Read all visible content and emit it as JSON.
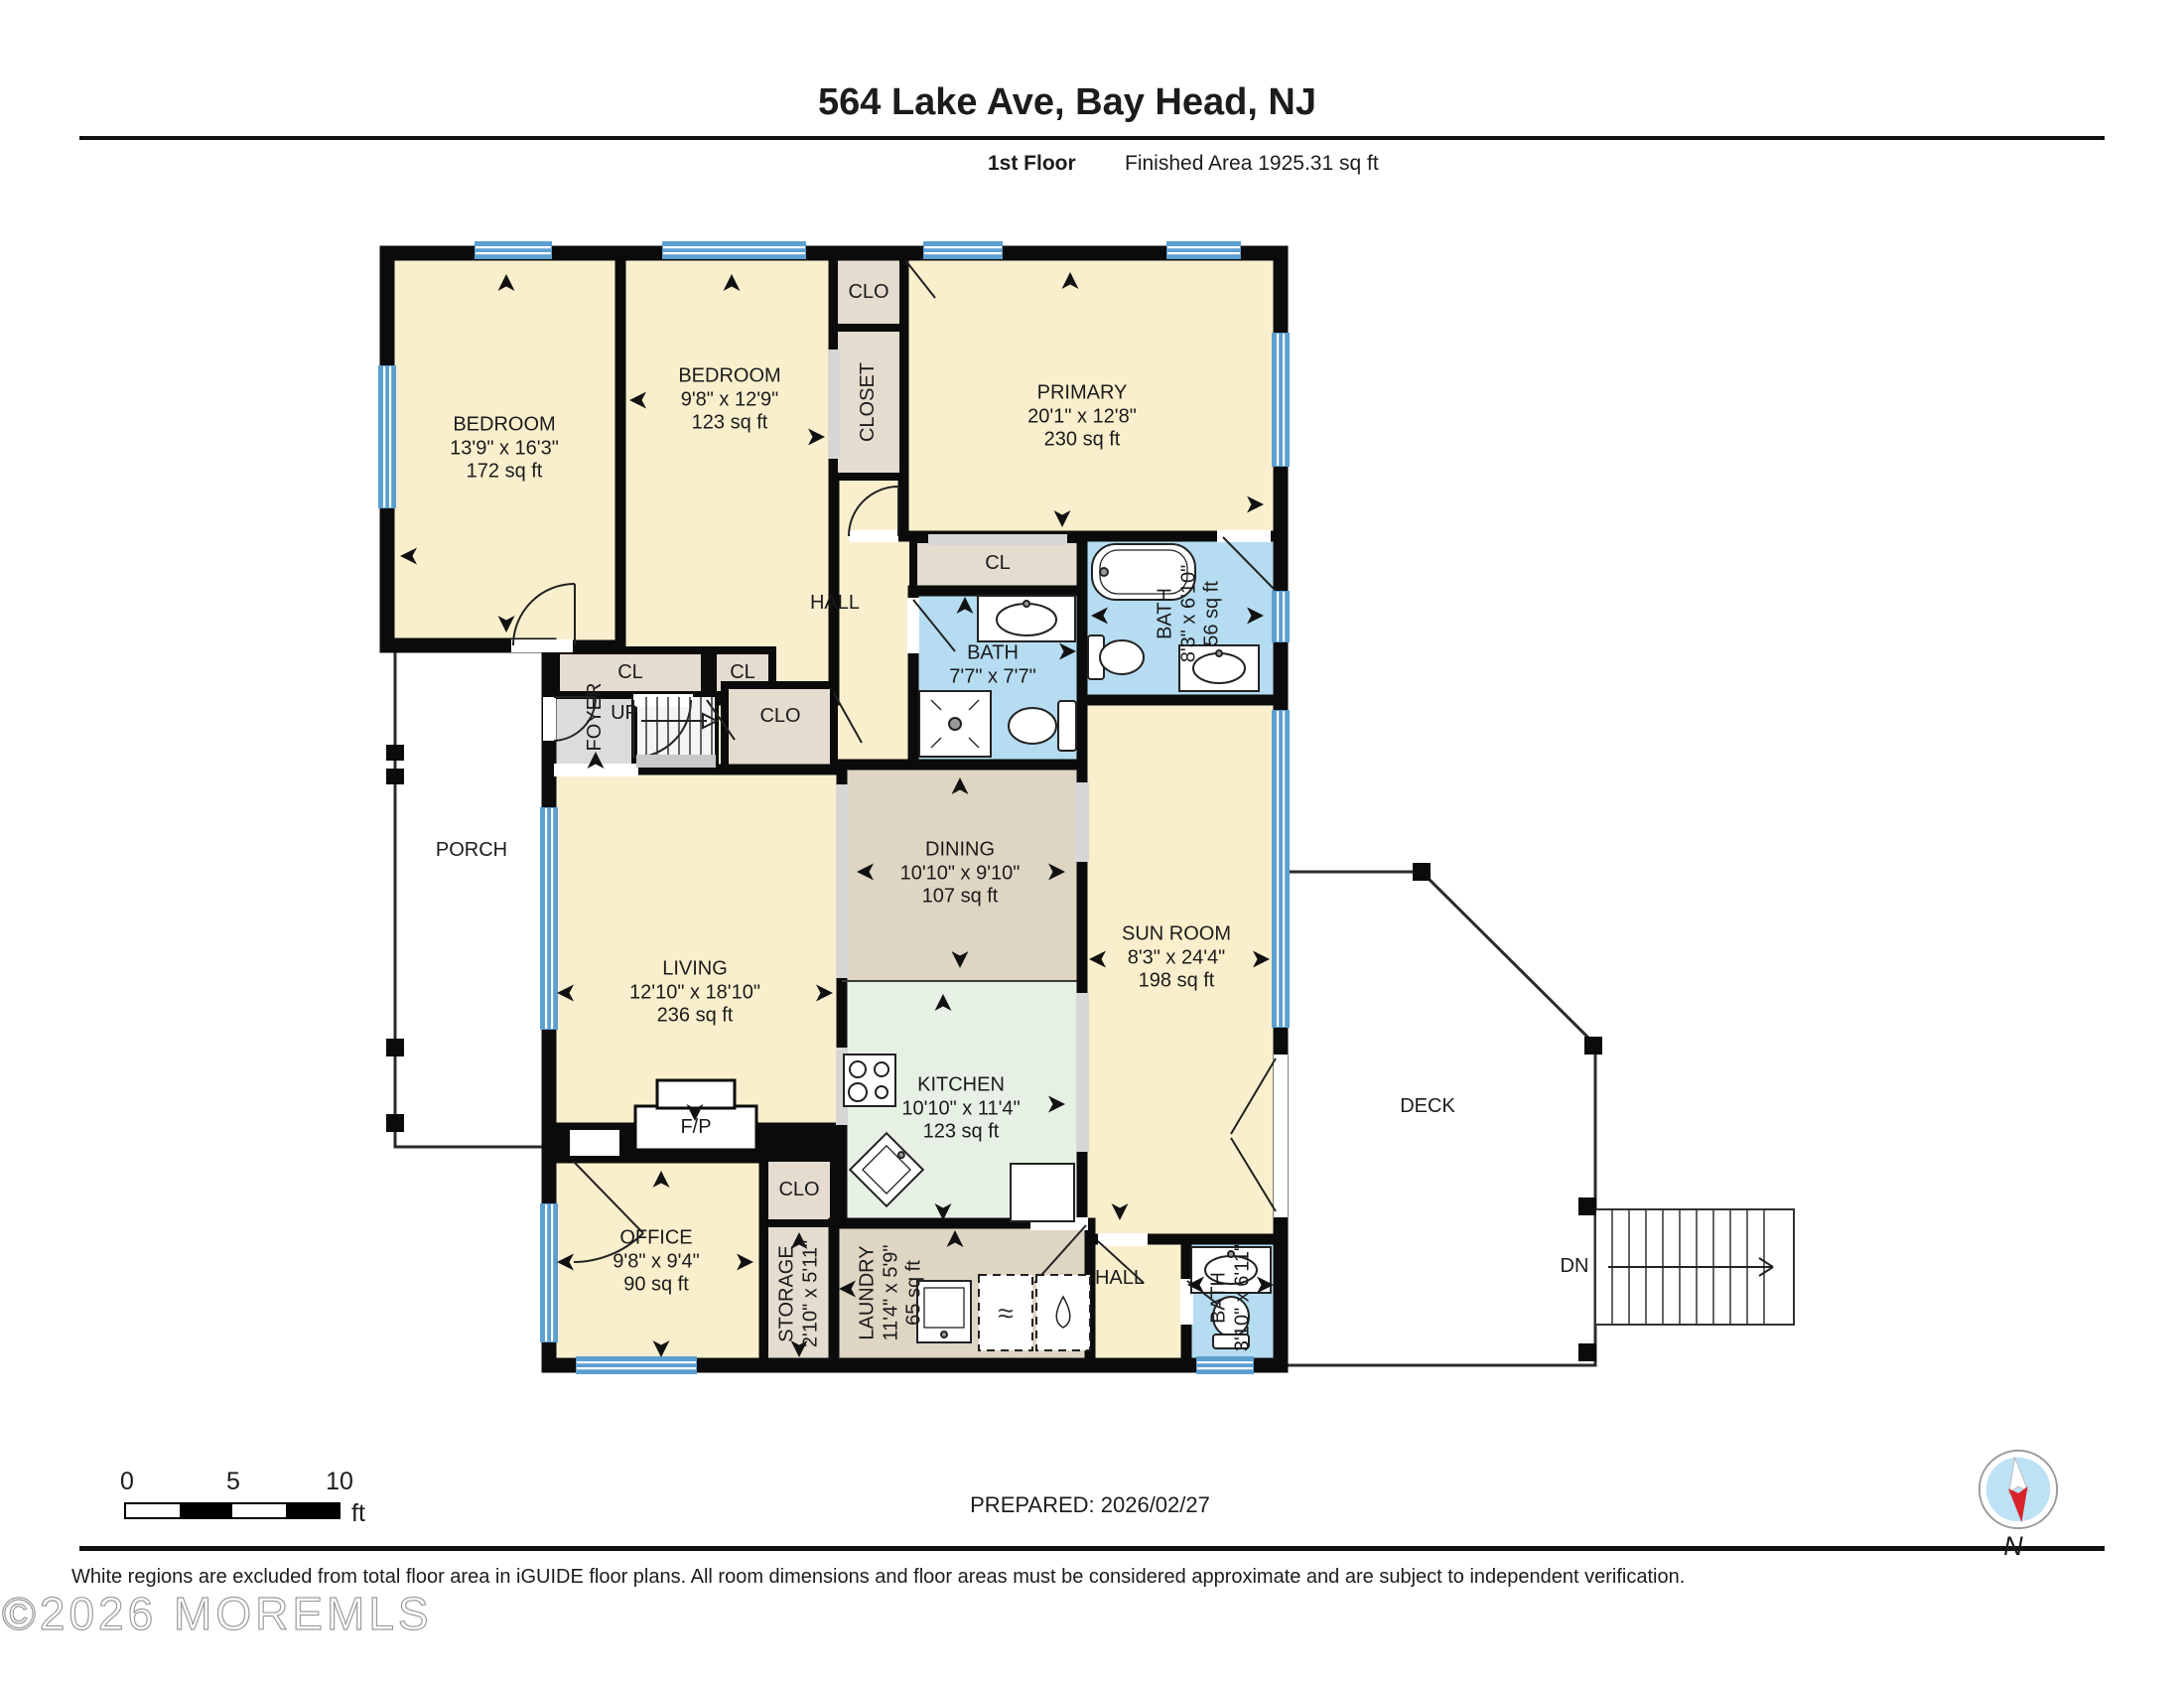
{
  "header": {
    "title": "564 Lake Ave, Bay Head, NJ",
    "floor_label": "1st Floor",
    "area_label": "Finished Area 1925.31 sq ft"
  },
  "rooms": {
    "bedroom1": {
      "name": "BEDROOM",
      "dims": "13'9\" x 16'3\"",
      "area": "172 sq ft"
    },
    "bedroom2": {
      "name": "BEDROOM",
      "dims": "9'8\" x 12'9\"",
      "area": "123 sq ft"
    },
    "primary": {
      "name": "PRIMARY",
      "dims": "20'1\" x 12'8\"",
      "area": "230 sq ft"
    },
    "clo_top": {
      "name": "CLO"
    },
    "closet_vert": {
      "name": "CLOSET"
    },
    "hall_upper": {
      "name": "HALL"
    },
    "cl1": {
      "name": "CL"
    },
    "cl2": {
      "name": "CL"
    },
    "foyer": {
      "name": "FOYER"
    },
    "up": {
      "name": "UP"
    },
    "clo_mid": {
      "name": "CLO"
    },
    "bath1": {
      "name": "BATH",
      "dims": "7'7\" x 7'7\""
    },
    "cl_primary": {
      "name": "CL"
    },
    "bath2": {
      "name": "BATH",
      "dims": "8'3\" x 6'10\"",
      "area": "56 sq ft"
    },
    "dining": {
      "name": "DINING",
      "dims": "10'10\" x 9'10\"",
      "area": "107 sq ft"
    },
    "living": {
      "name": "LIVING",
      "dims": "12'10\" x 18'10\"",
      "area": "236 sq ft"
    },
    "sunroom": {
      "name": "SUN ROOM",
      "dims": "8'3\" x 24'4\"",
      "area": "198 sq ft"
    },
    "kitchen": {
      "name": "KITCHEN",
      "dims": "10'10\" x 11'4\"",
      "area": "123 sq ft"
    },
    "porch": {
      "name": "PORCH"
    },
    "fireplace": {
      "name": "F/P"
    },
    "office": {
      "name": "OFFICE",
      "dims": "9'8\" x 9'4\"",
      "area": "90 sq ft"
    },
    "clo_office": {
      "name": "CLO"
    },
    "storage": {
      "name": "STORAGE",
      "dims": "2'10\" x 5'11\""
    },
    "laundry": {
      "name": "LAUNDRY",
      "dims": "11'4\" x 5'9\"",
      "area": "65 sq ft"
    },
    "hall_lower": {
      "name": "HALL"
    },
    "bath3": {
      "name": "BATH",
      "dims": "3'10\" x 6'11\""
    },
    "deck": {
      "name": "DECK"
    },
    "stairs_down": {
      "name": "DN"
    }
  },
  "footer": {
    "scale_ticks": [
      "0",
      "5",
      "10"
    ],
    "scale_unit": "ft",
    "prepared": "PREPARED: 2026/02/27",
    "compass_label": "N",
    "disclaimer": "White regions are excluded from total floor area in iGUIDE floor plans. All room dimensions and floor areas must be considered approximate and are subject to independent verification.",
    "watermark": "©2026 MOREMLS"
  },
  "colors": {
    "room_cream": "#FAEFCD",
    "room_greige": "#DFD5C3",
    "room_green": "#E7F0E5",
    "room_bath_blue": "#B5DCF1",
    "room_closet_tan": "#E4DCCF",
    "foyer_gray": "#DCDCDC",
    "wall_black": "#0B0B0B",
    "window_blue": "#5C9FD1",
    "compass_red": "#D8232A",
    "compass_blue": "#BDE2F6"
  }
}
